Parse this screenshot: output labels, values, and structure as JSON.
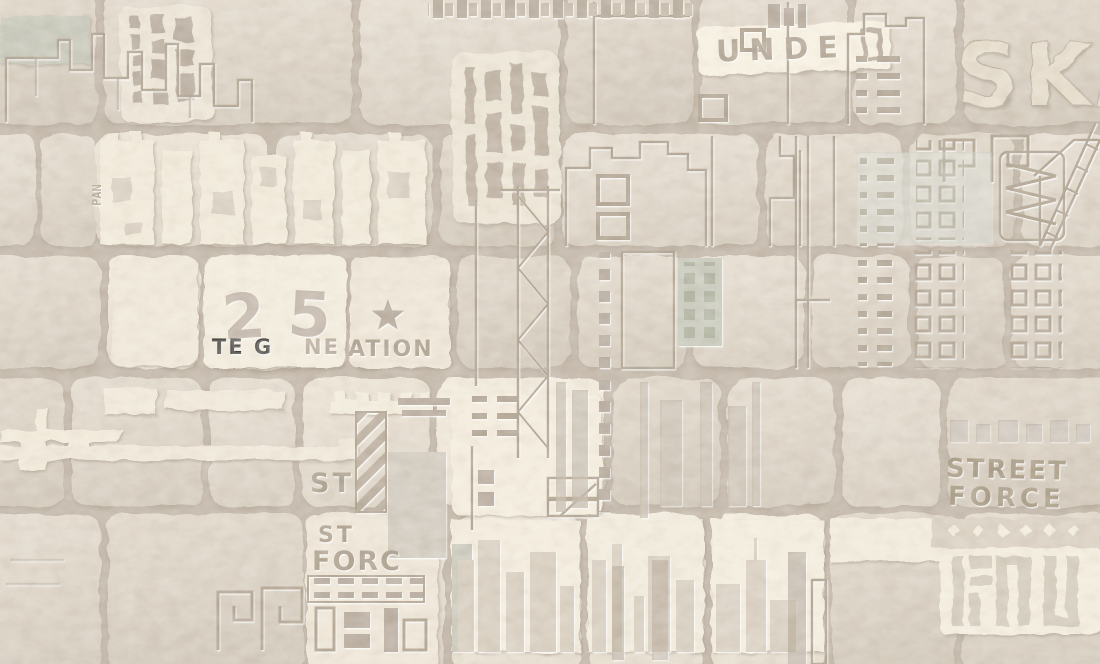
{
  "image": {
    "kind": "wallpaper-texture-photo",
    "alt": "Beige stone brick wall wallpaper embossed with urban city skylines, fire escapes, window grids and stencil graffiti lettering"
  },
  "palette": {
    "mortar": "#b2a698",
    "brick": "#d2c8b9",
    "brick_light": "#e0d7c7",
    "cream": "#ece3d2",
    "cream_bright": "#f4eddc",
    "emboss_dark": "#9a8d7d",
    "emboss_soft": "#a4978a",
    "engraved_text": "#95887a",
    "sage": "#b9bcae",
    "shadow": "#8f8375"
  },
  "stencil": {
    "unde": "UNDE",
    "ska": "SKA",
    "pan": "PAN",
    "digit_two": "2",
    "digit_five": "5",
    "generation_fragment_a": "TE G",
    "generation_fragment_b": "NE",
    "generation_fragment_c": "ATION",
    "st_upper": "ST",
    "street": "STREET",
    "force": "FORCE",
    "st_lower": "ST",
    "forc": "FORC"
  }
}
